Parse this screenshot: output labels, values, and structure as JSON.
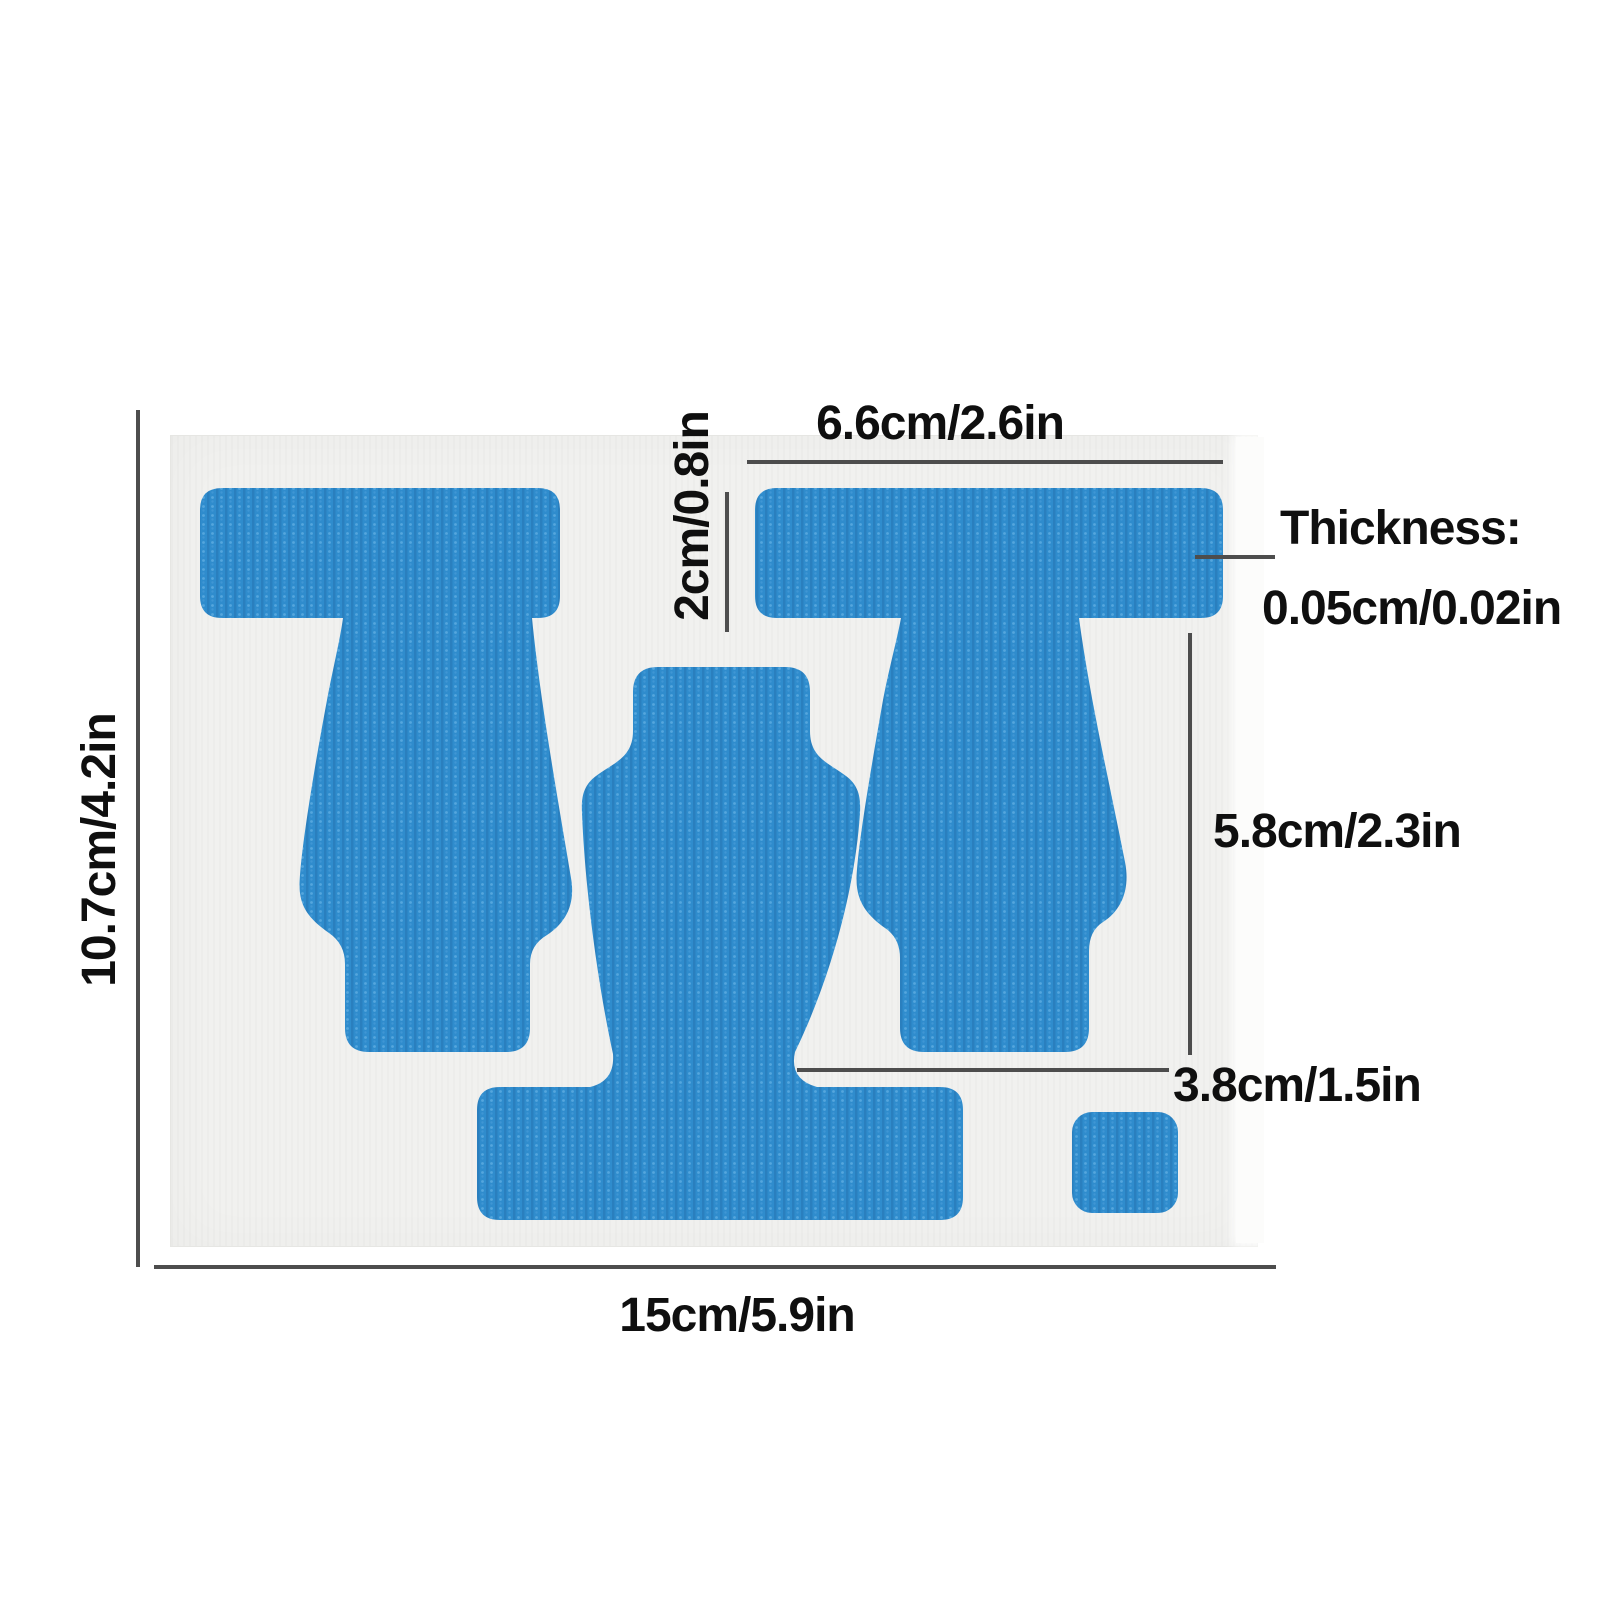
{
  "labels": {
    "sheet_width": "15cm/5.9in",
    "sheet_height": "10.7cm/4.2in",
    "top_width": "6.6cm/2.6in",
    "bar_height": "2cm/0.8in",
    "thickness_title": "Thickness:",
    "thickness_value": "0.05cm/0.02in",
    "body_height": "5.8cm/2.3in",
    "foot_width": "3.8cm/1.5in"
  },
  "colors": {
    "tape_base": "#2f8ccd",
    "tape_rib": "#2a7fbe",
    "tape_dot_light": "#55a6dd",
    "tape_dot_mid": "#3f96d4",
    "sheet": "#f1f1ef",
    "background": "#ffffff",
    "dimension_line": "#4d4d4d",
    "text": "#0f0f0f"
  },
  "patches": [
    "left-t-shaped-tape",
    "right-t-shaped-tape",
    "center-tape-with-base-bar",
    "small-square-tape"
  ]
}
